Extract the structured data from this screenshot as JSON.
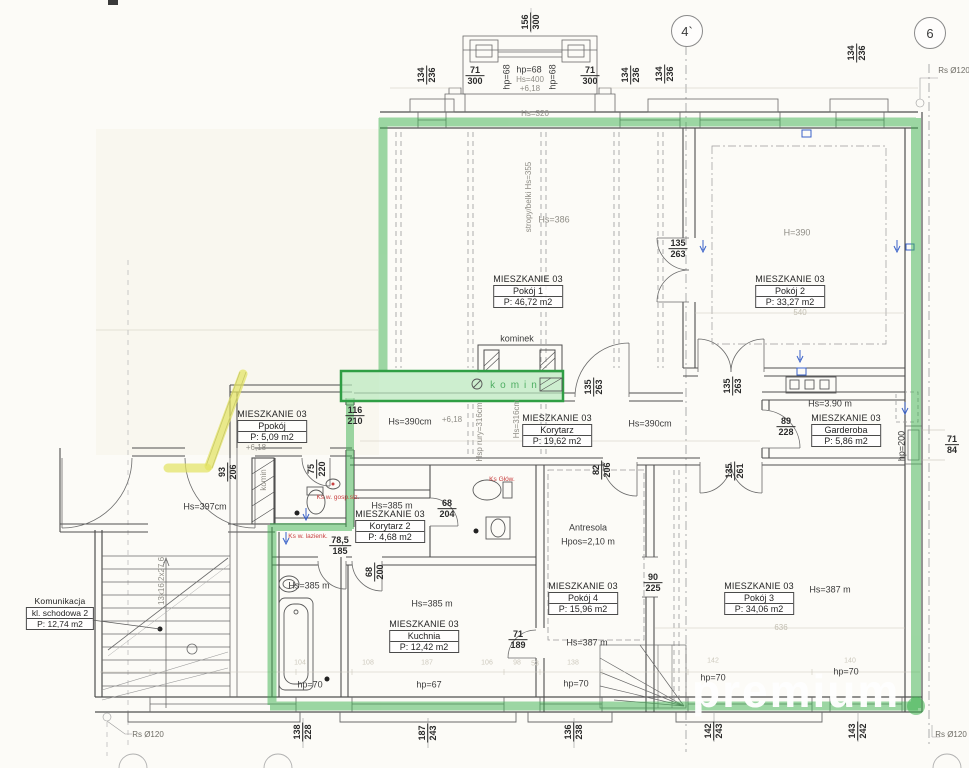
{
  "grid_markers": [
    {
      "label": "4`"
    },
    {
      "label": "6"
    }
  ],
  "rooms": [
    {
      "unit": "MIESZKANIE 03",
      "name": "Pokój 1",
      "area": "P: 46,72 m2"
    },
    {
      "unit": "MIESZKANIE 03",
      "name": "Pokój 2",
      "area": "P: 33,27 m2"
    },
    {
      "unit": "MIESZKANIE 03",
      "name": "Korytarz",
      "area": "P: 19,62 m2"
    },
    {
      "unit": "MIESZKANIE 03",
      "name": "Ppokój",
      "area": "P: 5,09 m2"
    },
    {
      "unit": "MIESZKANIE 03",
      "name": "Garderoba",
      "area": "P: 5,86 m2"
    },
    {
      "unit": "MIESZKANIE 03",
      "name": "Korytarz 2",
      "area": "P: 4,68 m2"
    },
    {
      "unit": "MIESZKANIE 03",
      "name": "Kuchnia",
      "area": "P: 12,42 m2"
    },
    {
      "unit": "MIESZKANIE 03",
      "name": "Pokój 4",
      "area": "P: 15,96 m2"
    },
    {
      "unit": "MIESZKANIE 03",
      "name": "Pokój 3",
      "area": "P: 34,06 m2"
    },
    {
      "unit": "Komunikacja",
      "name": "kl. schodowa 2",
      "area": "P: 12,74 m2"
    }
  ],
  "antresola": {
    "title": "Antresola",
    "height": "Hpos=2,10 m"
  },
  "dims": [
    {
      "a": "156",
      "b": "300"
    },
    {
      "a": "71",
      "b": "300"
    },
    {
      "a": "71",
      "b": "300"
    },
    {
      "a": "134",
      "b": "236"
    },
    {
      "a": "134",
      "b": "236"
    },
    {
      "a": "134",
      "b": "236"
    },
    {
      "a": "134",
      "b": "236"
    },
    {
      "a": "135",
      "b": "263"
    },
    {
      "a": "135",
      "b": "263"
    },
    {
      "a": "135",
      "b": "263"
    },
    {
      "a": "135",
      "b": "261"
    },
    {
      "a": "116",
      "b": "210"
    },
    {
      "a": "93",
      "b": "206"
    },
    {
      "a": "75",
      "b": "220"
    },
    {
      "a": "89",
      "b": "228"
    },
    {
      "a": "71",
      "b": "84"
    },
    {
      "a": "82",
      "b": "206"
    },
    {
      "a": "68",
      "b": "204"
    },
    {
      "a": "78,5",
      "b": "185"
    },
    {
      "a": "68",
      "b": "200"
    },
    {
      "a": "90",
      "b": "225"
    },
    {
      "a": "71",
      "b": "189"
    },
    {
      "a": "138",
      "b": "228"
    },
    {
      "a": "187",
      "b": "243"
    },
    {
      "a": "136",
      "b": "238"
    },
    {
      "a": "142",
      "b": "243"
    },
    {
      "a": "143",
      "b": "242"
    }
  ],
  "texts": [
    {
      "text": "hp=68"
    },
    {
      "text": "hp=68"
    },
    {
      "text": "hp=68"
    },
    {
      "text": "Hs=400"
    },
    {
      "text": "+6,18"
    },
    {
      "text": "Hs=320"
    },
    {
      "text": "Hs=386"
    },
    {
      "text": "stropy/belki Hs=355"
    },
    {
      "text": "H=390"
    },
    {
      "text": "kominek"
    },
    {
      "text": "Hs=390cm"
    },
    {
      "text": "+6,18"
    },
    {
      "text": "Hsp rury=316cm"
    },
    {
      "text": "Hs=316cm"
    },
    {
      "text": "Hs=390cm"
    },
    {
      "text": "Hs=3.90 m"
    },
    {
      "text": "hp=200"
    },
    {
      "text": "+6,18"
    },
    {
      "text": "Hs=397cm"
    },
    {
      "text": "komin"
    },
    {
      "text": "Hs=385 m"
    },
    {
      "text": "Hs=385 m"
    },
    {
      "text": "Hs=385 m"
    },
    {
      "text": "Hs=387 m"
    },
    {
      "text": "Hs=387 m"
    },
    {
      "text": "hp=70"
    },
    {
      "text": "hp=67"
    },
    {
      "text": "hp=70"
    },
    {
      "text": "13x16,2x27,6"
    },
    {
      "text": "Rs Ø120"
    },
    {
      "text": "Rs Ø120"
    },
    {
      "text": "Rs Ø120"
    },
    {
      "text": "540"
    },
    {
      "text": "1072"
    },
    {
      "text": "636"
    },
    {
      "text": "komin"
    },
    {
      "text": "hp=70"
    },
    {
      "text": "hp=70"
    },
    {
      "text": "104"
    },
    {
      "text": "108"
    },
    {
      "text": "187"
    },
    {
      "text": "106"
    },
    {
      "text": "98"
    },
    {
      "text": "53"
    },
    {
      "text": "138"
    },
    {
      "text": "142"
    },
    {
      "text": "140"
    }
  ],
  "red_notes": [
    {
      "text": "Ks w. gosp.siz."
    },
    {
      "text": "Ks w. lazienk."
    },
    {
      "text": "Ks Głów."
    }
  ],
  "watermark": {
    "text": "premium"
  },
  "colors": {
    "highlight_green": "#3cb24f",
    "highlight_yellow": "#e3e35f",
    "note_red": "#c84040",
    "mark_blue": "#3a62c9"
  }
}
